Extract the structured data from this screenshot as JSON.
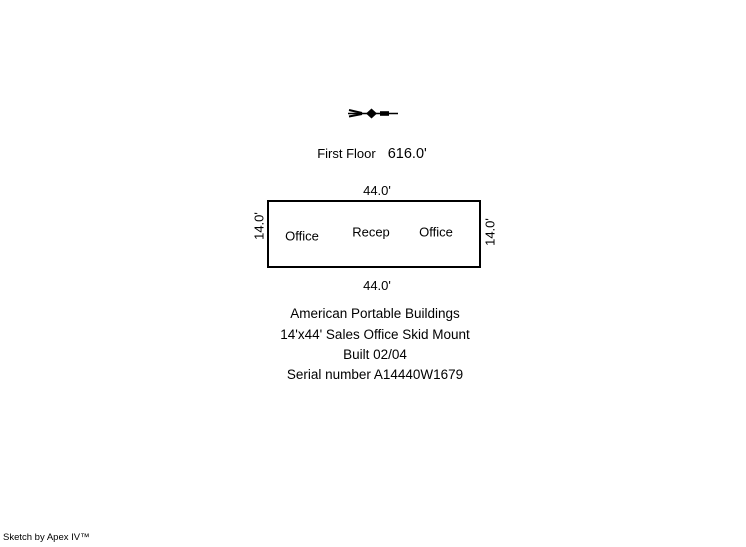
{
  "canvas": {
    "background_color": "#ffffff",
    "ink_color": "#000000"
  },
  "icons": {
    "north_arrow": "compass-needle-horizontal"
  },
  "floor": {
    "name": "First Floor",
    "area": "616.0'"
  },
  "plan": {
    "dim_top": "44.0'",
    "dim_bottom": "44.0'",
    "dim_left": "14.0'",
    "dim_right": "14.0'",
    "rooms": [
      {
        "label": "Office"
      },
      {
        "label": "Recep"
      },
      {
        "label": "Office"
      }
    ]
  },
  "description": {
    "lines": [
      "American Portable Buildings",
      "14'x44' Sales Office Skid Mount",
      "Built 02/04",
      "Serial number A14440W1679"
    ]
  },
  "footer": {
    "credit": "Sketch by Apex IV™"
  }
}
